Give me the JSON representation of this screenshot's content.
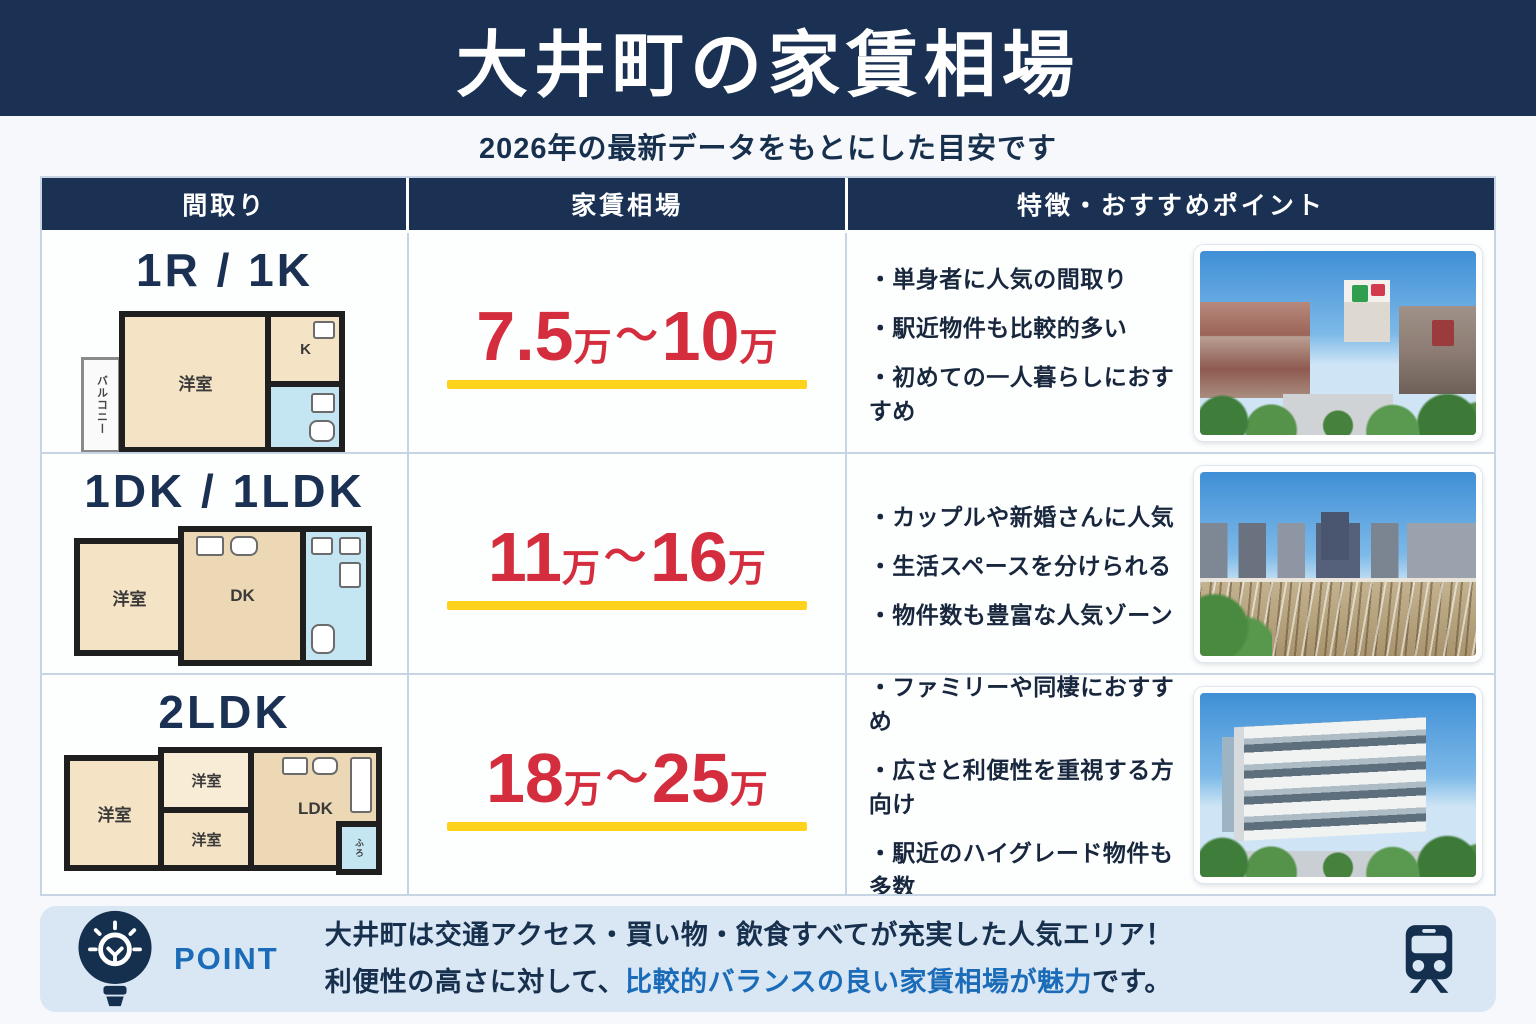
{
  "header": {
    "title": "大井町の家賃相場",
    "subtitle": "2026年の最新データをもとにした目安です"
  },
  "table": {
    "columns": [
      "間取り",
      "家賃相場",
      "特徴・おすすめポイント"
    ],
    "rows": [
      {
        "layout": "1R / 1K",
        "price": {
          "min": "7.5",
          "unit": "万",
          "tilde": "〜",
          "max": "10"
        },
        "features": [
          "・単身者に人気の間取り",
          "・駅近物件も比較的多い",
          "・初めての一人暮らしにおすすめ"
        ],
        "floorplan": {
          "room1": "洋室",
          "kitchen": "K",
          "balcony": "バルコニー"
        },
        "photo_name": "oimachi-station-area-photo"
      },
      {
        "layout": "1DK / 1LDK",
        "price": {
          "min": "11",
          "unit": "万",
          "tilde": "〜",
          "max": "16"
        },
        "features": [
          "・カップルや新婚さんに人気",
          "・生活スペースを分けられる",
          "・物件数も豊富な人気ゾーン"
        ],
        "floorplan": {
          "room1": "洋室",
          "dk": "DK"
        },
        "photo_name": "railway-cityscape-photo"
      },
      {
        "layout": "2LDK",
        "price": {
          "min": "18",
          "unit": "万",
          "tilde": "〜",
          "max": "25"
        },
        "features": [
          "・ファミリーや同棲におすすめ",
          "・広さと利便性を重視する方向け",
          "・駅近のハイグレード物件も多数"
        ],
        "floorplan": {
          "room1": "洋室",
          "room2": "洋室",
          "room3": "洋室",
          "ldk": "LDK",
          "bath": "ふろ"
        },
        "photo_name": "apartment-building-photo"
      }
    ]
  },
  "point": {
    "label": "POINT",
    "line1": "大井町は交通アクセス・買い物・飲食すべてが充実した人気エリア！",
    "line2_prefix": "利便性の高さに対して、",
    "line2_highlight": "比較的バランスの良い家賃相場が魅力",
    "line2_suffix": "です。",
    "icons": [
      "lightbulb-icon",
      "train-icon"
    ]
  },
  "colors": {
    "navy": "#1b3153",
    "price_red": "#d42e3e",
    "underline_yellow": "#ffd21c",
    "point_bg": "#d9e6f4",
    "point_blue": "#1b6cb8",
    "floor_beige": "#f4e3c4",
    "bath_blue": "#c4e5f2"
  }
}
